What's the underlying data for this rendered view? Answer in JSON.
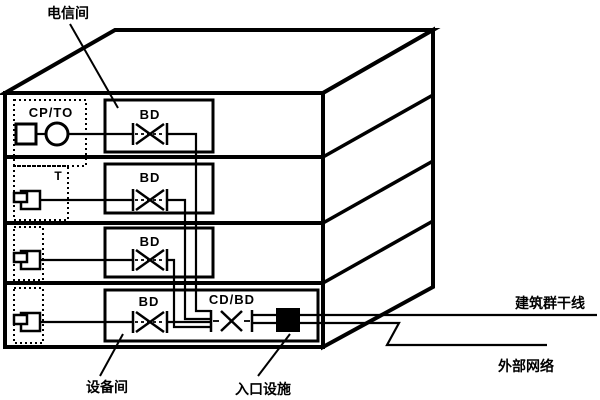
{
  "diagram": {
    "labels": {
      "telecom_room": "电信间",
      "equipment_room": "设备间",
      "entrance_facility": "入口设施",
      "campus_backbone": "建筑群干线",
      "external_network": "外部网络"
    },
    "floor1": {
      "zone": "CP/TO",
      "distributor": "BD"
    },
    "floor2": {
      "zone": "T",
      "distributor": "BD"
    },
    "floor3": {
      "distributor": "BD"
    },
    "floor4": {
      "distributor": "BD",
      "building_distributor": "CD/BD"
    },
    "colors": {
      "line": "#000000",
      "background": "#ffffff",
      "entrance_fill": "#000000"
    }
  }
}
